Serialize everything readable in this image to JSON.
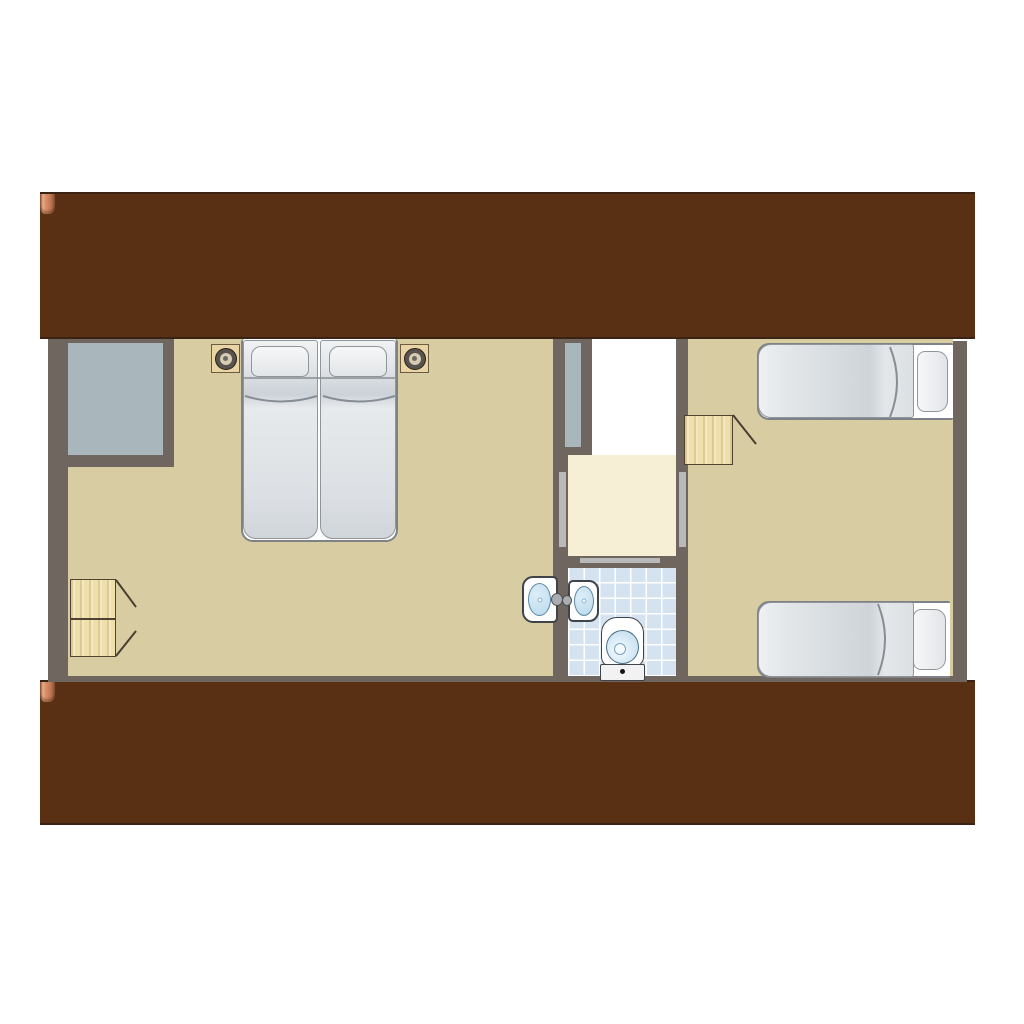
{
  "scene": {
    "type": "architectural-floor-plan",
    "view": "top-down attic storey between two tiled roof slopes",
    "text_labels": []
  },
  "colors": {
    "wall": "#6e665f",
    "floor": "#d8cda2",
    "landing": "#f7efd5",
    "voidc": "#a9b7bd",
    "doorway": "#b9b9b9",
    "bathtile": "#d5e2ef",
    "grout": "#ffffff",
    "wood": "#eedfab",
    "woodline": "#4f432f",
    "stairw1": "#e3c89c",
    "stairw2": "#d2ae7e",
    "stairline": "#5f4a30",
    "frame": "#ffffff",
    "outline": "#7e8287",
    "basin": "#b9d9ec",
    "fixline": "#3f444a",
    "roofedge": "#3a2215",
    "roofbase": "#5a3014"
  },
  "roof": {
    "rows": 8,
    "cols": 63,
    "tile_width_px": 15,
    "tile_height_px": 20,
    "palette": [
      "#cf7e55",
      "#e0916a",
      "#b06442",
      "#9a5637",
      "#c5714b",
      "#d9885f",
      "#c99877",
      "#a86a49",
      "#8f4f33",
      "#e39d78"
    ]
  },
  "stairs": {
    "step_count": 7
  },
  "bathroom": {
    "tile_size_px": 15,
    "fixtures": [
      "toilet",
      "wash-basin"
    ]
  },
  "rooms": [
    {
      "id": "bedroom-left",
      "contents": [
        "double bed with two mattresses and two pillows",
        "nightstand with lamp (left)",
        "nightstand with lamp (right)",
        "gray void recess at top-left",
        "two-door wardrobe at bottom-left",
        "wash basin on bathroom wall"
      ]
    },
    {
      "id": "stair-hall",
      "contents": [
        "wooden staircase of 7 treads",
        "stairwell void strip",
        "landing",
        "open doorway to left bedroom",
        "open doorway to right bedroom",
        "sliding door to bathroom"
      ]
    },
    {
      "id": "bathroom",
      "contents": [
        "blue tiled floor",
        "toilet",
        "wash basin"
      ]
    },
    {
      "id": "bedroom-right",
      "contents": [
        "single bed with pillow (top)",
        "single bed with pillow (bottom)",
        "wooden cabinet with open door"
      ]
    }
  ]
}
